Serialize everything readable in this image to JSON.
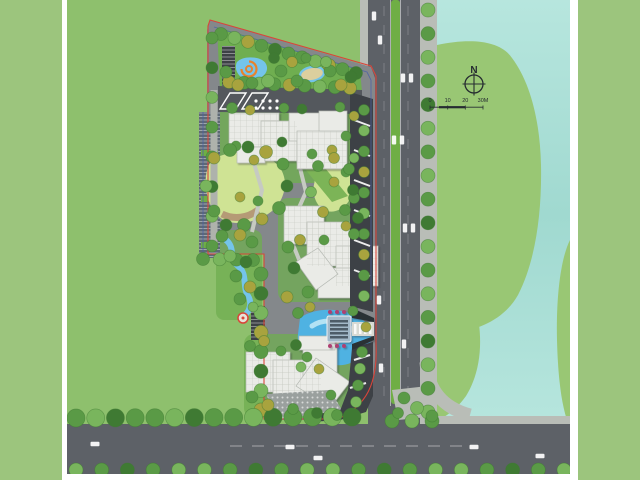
{
  "compass": {
    "label": "N"
  },
  "scale_bar": {
    "labels": [
      "0",
      "10",
      "20",
      "30M"
    ]
  },
  "colors": {
    "border": "#9cc57d",
    "field": "#8ec06d",
    "water_light": "#b7e6de",
    "water": "#a0d9d0",
    "blob": "#99c774",
    "road": "#5d6167",
    "median": "#6fae45",
    "sidewalk": "#b9bdb7",
    "paving": "#84888b",
    "plaza": "#54585d",
    "dark": "#3d4146",
    "garage": "#5e6974",
    "building": "#eaebe7",
    "building_line": "#b4b8b2",
    "lawn": "#cfe394",
    "park": "#6fae50",
    "pond": "#74c4ea",
    "pool": "#4fb2e2",
    "pool_light": "#b3e2f4",
    "sand": "#dccf9e",
    "tan": "#b59a76",
    "orange": "#e8832c",
    "red": "#d9453a",
    "blueline": "#4a5fa8",
    "gate": "#a3b9c9",
    "wall_dark": "#2c3034",
    "hex": "#9aa09e",
    "island": "#e9e1c6",
    "magenta": "#ae3f72",
    "walk": "#aeb2ac",
    "path_light": "#c6cac2",
    "tree_dark": "#3f7a33",
    "tree_mid": "#5a9a46",
    "tree_light": "#79b55d",
    "tree_olive": "#a8a33e",
    "ink": "#262c31"
  },
  "landscape": {
    "tree_rows": [
      {
        "f": [
          221,
          34
        ],
        "t": [
          356,
          73
        ],
        "n": 11,
        "r": 6.5,
        "p": [
          "mid",
          "light",
          "olive",
          "mid",
          "dark",
          "mid"
        ]
      },
      {
        "f": [
          229,
          82
        ],
        "t": [
          350,
          88
        ],
        "n": 9,
        "r": 6.5,
        "p": [
          "olive",
          "mid",
          "light",
          "mid"
        ]
      },
      {
        "f": [
          212,
          38
        ],
        "t": [
          212,
          246
        ],
        "n": 8,
        "r": 6,
        "p": [
          "mid",
          "dark",
          "light",
          "mid"
        ]
      },
      {
        "f": [
          203,
          259
        ],
        "t": [
          253,
          260
        ],
        "n": 4,
        "r": 6.5,
        "p": [
          "mid",
          "light",
          "mid"
        ]
      },
      {
        "f": [
          261,
          274
        ],
        "t": [
          261,
          410
        ],
        "n": 8,
        "r": 7,
        "p": [
          "mid",
          "dark",
          "light",
          "olive"
        ]
      },
      {
        "f": [
          364,
          110
        ],
        "t": [
          364,
          296
        ],
        "n": 10,
        "r": 5.5,
        "p": [
          "mid",
          "light",
          "mid",
          "olive"
        ]
      },
      {
        "f": [
          362,
          352
        ],
        "t": [
          356,
          402
        ],
        "n": 4,
        "r": 5.5,
        "p": [
          "mid",
          "light"
        ]
      },
      {
        "f": [
          428,
          10
        ],
        "t": [
          428,
          412
        ],
        "n": 18,
        "r": 7,
        "p": [
          "light",
          "mid",
          "light",
          "mid",
          "dark"
        ]
      },
      {
        "f": [
          76,
          418
        ],
        "t": [
          352,
          417
        ],
        "n": 15,
        "r": 9,
        "p": [
          "mid",
          "light",
          "dark",
          "mid"
        ]
      },
      {
        "f": [
          392,
          421
        ],
        "t": [
          432,
          421
        ],
        "n": 3,
        "r": 7,
        "p": [
          "mid",
          "light"
        ]
      },
      {
        "f": [
          76,
          470
        ],
        "t": [
          564,
          470
        ],
        "n": 20,
        "r": 7,
        "p": [
          "light",
          "mid",
          "dark",
          "mid",
          "light"
        ]
      }
    ],
    "trees": [
      [
        226,
        72,
        6,
        "mid"
      ],
      [
        238,
        85,
        6,
        "olive"
      ],
      [
        252,
        83,
        6,
        "mid"
      ],
      [
        268,
        81,
        6.5,
        "light"
      ],
      [
        281,
        71,
        6,
        "mid"
      ],
      [
        292,
        62,
        5.5,
        "olive"
      ],
      [
        297,
        81,
        6,
        "mid"
      ],
      [
        330,
        71,
        6,
        "mid"
      ],
      [
        341,
        85,
        6,
        "olive"
      ],
      [
        351,
        77,
        6,
        "dark"
      ],
      [
        274,
        58,
        5.5,
        "dark"
      ],
      [
        306,
        58,
        5,
        "mid"
      ],
      [
        326,
        62,
        5.5,
        "light"
      ],
      [
        232,
        108,
        5.5,
        "mid"
      ],
      [
        250,
        110,
        5,
        "olive"
      ],
      [
        284,
        108,
        5,
        "mid"
      ],
      [
        302,
        109,
        5,
        "dark"
      ],
      [
        340,
        107,
        5,
        "mid"
      ],
      [
        354,
        116,
        5,
        "olive"
      ],
      [
        236,
        146,
        5,
        "mid"
      ],
      [
        254,
        160,
        5,
        "olive"
      ],
      [
        282,
        142,
        5,
        "dark"
      ],
      [
        312,
        154,
        5,
        "mid"
      ],
      [
        332,
        150,
        5,
        "olive"
      ],
      [
        346,
        136,
        5,
        "mid"
      ],
      [
        354,
        158,
        5,
        "light"
      ],
      [
        346,
        172,
        5,
        "mid"
      ],
      [
        334,
        182,
        5,
        "olive"
      ],
      [
        354,
        198,
        5.5,
        "mid"
      ],
      [
        358,
        218,
        5.5,
        "dark"
      ],
      [
        354,
        234,
        5.5,
        "mid"
      ],
      [
        346,
        226,
        5,
        "olive"
      ],
      [
        214,
        158,
        6,
        "olive"
      ],
      [
        230,
        150,
        6.5,
        "mid"
      ],
      [
        248,
        147,
        6,
        "dark"
      ],
      [
        266,
        152,
        6.5,
        "olive"
      ],
      [
        283,
        164,
        6,
        "mid"
      ],
      [
        287,
        186,
        6,
        "dark"
      ],
      [
        279,
        208,
        6.5,
        "mid"
      ],
      [
        262,
        219,
        6,
        "olive"
      ],
      [
        244,
        225,
        6.5,
        "mid"
      ],
      [
        226,
        225,
        6,
        "dark"
      ],
      [
        214,
        211,
        6,
        "mid"
      ],
      [
        206,
        186,
        6,
        "light"
      ],
      [
        240,
        197,
        5,
        "olive"
      ],
      [
        258,
        201,
        5,
        "mid"
      ],
      [
        318,
        166,
        5.5,
        "mid"
      ],
      [
        334,
        158,
        5.5,
        "olive"
      ],
      [
        349,
        169,
        5.5,
        "mid"
      ],
      [
        353,
        190,
        5.5,
        "dark"
      ],
      [
        345,
        210,
        5.5,
        "mid"
      ],
      [
        323,
        212,
        5.5,
        "olive"
      ],
      [
        311,
        192,
        5.5,
        "light"
      ],
      [
        288,
        247,
        6,
        "mid"
      ],
      [
        300,
        240,
        5.5,
        "olive"
      ],
      [
        294,
        268,
        6,
        "dark"
      ],
      [
        308,
        292,
        6,
        "mid"
      ],
      [
        287,
        297,
        6,
        "olive"
      ],
      [
        324,
        240,
        5,
        "mid"
      ],
      [
        222,
        236,
        6,
        "mid"
      ],
      [
        240,
        235,
        6,
        "olive"
      ],
      [
        252,
        242,
        6,
        "mid"
      ],
      [
        230,
        256,
        6,
        "light"
      ],
      [
        246,
        262,
        6,
        "dark"
      ],
      [
        236,
        276,
        6,
        "mid"
      ],
      [
        250,
        287,
        6,
        "olive"
      ],
      [
        240,
        299,
        6,
        "mid"
      ],
      [
        253,
        307,
        5,
        "light"
      ],
      [
        298,
        313,
        5.5,
        "mid"
      ],
      [
        310,
        307,
        5,
        "olive"
      ],
      [
        353,
        311,
        5,
        "mid"
      ],
      [
        366,
        327,
        5,
        "olive"
      ],
      [
        296,
        345,
        5.5,
        "dark"
      ],
      [
        307,
        357,
        5,
        "mid"
      ],
      [
        319,
        369,
        5,
        "olive"
      ],
      [
        250,
        346,
        5.5,
        "mid"
      ],
      [
        264,
        341,
        5.5,
        "olive"
      ],
      [
        281,
        351,
        5,
        "mid"
      ],
      [
        252,
        397,
        6,
        "mid"
      ],
      [
        268,
        405,
        6,
        "olive"
      ],
      [
        293,
        409,
        5.5,
        "mid"
      ],
      [
        317,
        413,
        5.5,
        "dark"
      ],
      [
        337,
        415,
        5.5,
        "mid"
      ],
      [
        301,
        367,
        5,
        "light"
      ],
      [
        331,
        395,
        5,
        "mid"
      ],
      [
        404,
        398,
        6,
        "mid"
      ],
      [
        417,
        408,
        6.5,
        "light"
      ],
      [
        398,
        413,
        5.5,
        "mid"
      ],
      [
        432,
        416,
        6,
        "mid"
      ]
    ],
    "cars": [
      [
        374,
        16,
        "v"
      ],
      [
        380,
        40,
        "v"
      ],
      [
        403,
        78,
        "v"
      ],
      [
        411,
        78,
        "v"
      ],
      [
        394,
        140,
        "v"
      ],
      [
        402,
        140,
        "v"
      ],
      [
        405,
        228,
        "v"
      ],
      [
        413,
        228,
        "v"
      ],
      [
        379,
        300,
        "v"
      ],
      [
        404,
        344,
        "v"
      ],
      [
        381,
        368,
        "v"
      ],
      [
        95,
        444,
        "h"
      ],
      [
        290,
        447,
        "h"
      ],
      [
        474,
        447,
        "h"
      ],
      [
        540,
        456,
        "h"
      ],
      [
        318,
        458,
        "h"
      ]
    ]
  }
}
